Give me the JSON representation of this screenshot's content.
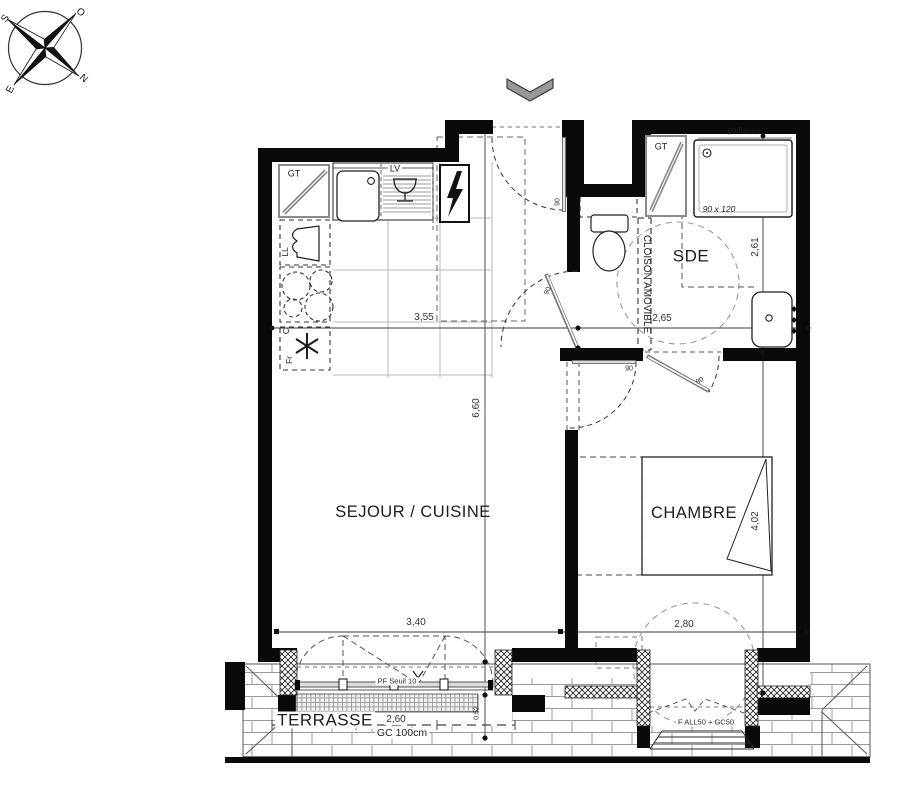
{
  "compass": {
    "letters": {
      "n": "N",
      "s": "S",
      "e": "E",
      "o": "O"
    }
  },
  "rooms": {
    "sejour_cuisine": "SEJOUR / CUISINE",
    "chambre": "CHAMBRE",
    "sde": "SDE",
    "terrasse": "TERRASSE"
  },
  "kitchen": {
    "gt": "GT",
    "lv": "LV",
    "ll": "LL",
    "cooktop": "C",
    "fridge": "Fr"
  },
  "sde": {
    "gt": "GT",
    "paillasse": "paillasse",
    "shower_size": "90 x 120",
    "cloison_amovible": "CLOISON AMOVIBLE"
  },
  "openings": {
    "pf_seuil": "PF Seuil 10",
    "gc": "GC 100cm",
    "f_all": "F ALL50 + GC50",
    "door_width_entry": "90",
    "door_width_sde": "90",
    "door_width_chambre": "90",
    "door_width_sde_chambre": "90"
  },
  "dimensions": {
    "kitchen_width": "3,55",
    "sde_width": "2,65",
    "sde_depth": "2,61",
    "sejour_length": "6,60",
    "chambre_length": "4,02",
    "sejour_width": "3,40",
    "chambre_width": "2,80",
    "terrasse_width": "2,60",
    "terrasse_edge": "0,52"
  },
  "colors": {
    "wall": "#0a0a0a",
    "chevron": "#98989a",
    "dim_text": "#33333d"
  }
}
